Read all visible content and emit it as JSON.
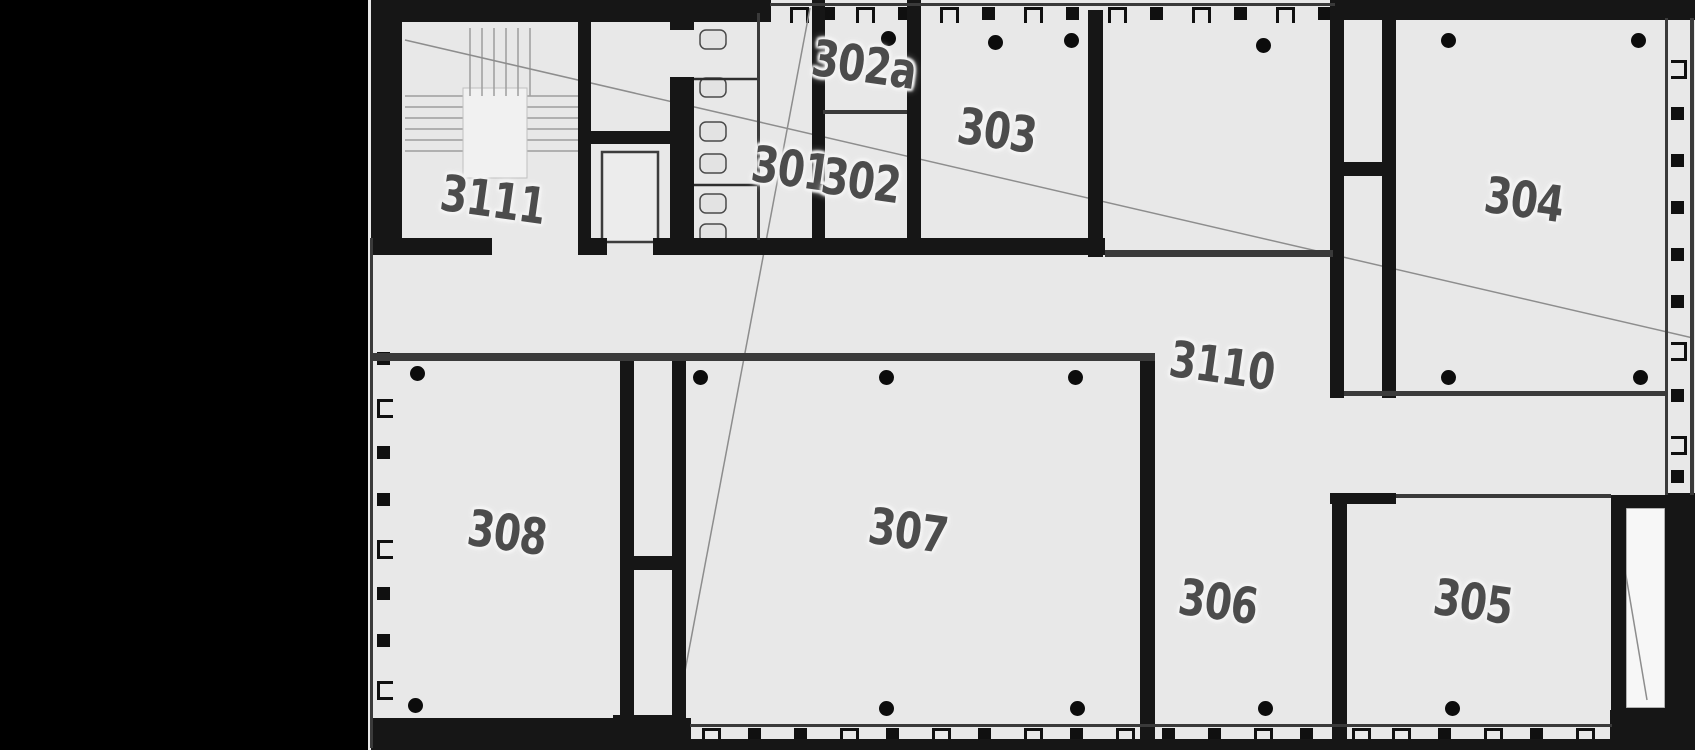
{
  "plan": {
    "colors": {
      "margin": "#000000",
      "floor": "#e8e8e8",
      "wall": "#161616",
      "thin_line": "#3a3a3a",
      "label_text": "#4c4c4c",
      "label_halo": "#f4f4f4",
      "leader_line": "#8d8d8d",
      "column_dot": "#0c0c0c"
    },
    "rooms": [
      {
        "label": "3111",
        "x": 493,
        "y": 200
      },
      {
        "label": "301",
        "x": 791,
        "y": 169
      },
      {
        "label": "302",
        "x": 861,
        "y": 181
      },
      {
        "label": "302a",
        "x": 864,
        "y": 65
      },
      {
        "label": "303",
        "x": 997,
        "y": 131
      },
      {
        "label": "304",
        "x": 1524,
        "y": 200
      },
      {
        "label": "3110",
        "x": 1222,
        "y": 366
      },
      {
        "label": "308",
        "x": 507,
        "y": 533
      },
      {
        "label": "307",
        "x": 908,
        "y": 531
      },
      {
        "label": "306",
        "x": 1218,
        "y": 602
      },
      {
        "label": "305",
        "x": 1473,
        "y": 602
      }
    ],
    "walls": [
      [
        371,
        0,
        400,
        22
      ],
      [
        1333,
        0,
        362,
        20
      ],
      [
        371,
        0,
        31,
        241
      ],
      [
        371,
        718,
        320,
        32
      ],
      [
        690,
        739,
        922,
        11
      ],
      [
        1610,
        710,
        85,
        40
      ],
      [
        1665,
        493,
        30,
        257
      ],
      [
        578,
        0,
        13,
        255
      ],
      [
        670,
        0,
        24,
        30
      ],
      [
        670,
        77,
        24,
        178
      ],
      [
        812,
        0,
        13,
        255
      ],
      [
        907,
        0,
        14,
        255
      ],
      [
        1088,
        10,
        15,
        247
      ],
      [
        1330,
        0,
        14,
        398
      ],
      [
        1382,
        0,
        14,
        398
      ],
      [
        1330,
        162,
        66,
        14
      ],
      [
        1140,
        357,
        15,
        382
      ],
      [
        620,
        357,
        14,
        360
      ],
      [
        672,
        357,
        14,
        382
      ],
      [
        620,
        556,
        66,
        14
      ],
      [
        613,
        715,
        73,
        35
      ],
      [
        1332,
        493,
        15,
        246
      ],
      [
        1330,
        493,
        66,
        11
      ],
      [
        1611,
        495,
        60,
        13
      ],
      [
        1611,
        708,
        60,
        35
      ],
      [
        1611,
        495,
        15,
        244
      ],
      [
        371,
        238,
        121,
        17
      ],
      [
        591,
        238,
        16,
        17
      ],
      [
        653,
        238,
        452,
        17
      ],
      [
        591,
        131,
        79,
        13
      ]
    ],
    "lines": [
      [
        770,
        3,
        565,
        3
      ],
      [
        370,
        238,
        3,
        510
      ],
      [
        690,
        724,
        922,
        3
      ],
      [
        1665,
        18,
        3,
        477
      ],
      [
        1690,
        18,
        4,
        477
      ],
      [
        757,
        13,
        3,
        227
      ],
      [
        823,
        110,
        84,
        4
      ],
      [
        1105,
        250,
        228,
        7
      ],
      [
        373,
        353,
        782,
        8
      ],
      [
        1344,
        391,
        321,
        5
      ],
      [
        1396,
        494,
        215,
        4
      ]
    ],
    "window_marks": {
      "size": 13,
      "items": [
        [
          790,
          7,
          "ob"
        ],
        [
          822,
          7,
          "f"
        ],
        [
          856,
          7,
          "ob"
        ],
        [
          898,
          7,
          "f"
        ],
        [
          940,
          7,
          "ob"
        ],
        [
          982,
          7,
          "f"
        ],
        [
          1024,
          7,
          "ob"
        ],
        [
          1066,
          7,
          "f"
        ],
        [
          1108,
          7,
          "ob"
        ],
        [
          1150,
          7,
          "f"
        ],
        [
          1192,
          7,
          "ob"
        ],
        [
          1234,
          7,
          "f"
        ],
        [
          1276,
          7,
          "ob"
        ],
        [
          1318,
          7,
          "f"
        ],
        [
          702,
          728,
          "ob"
        ],
        [
          748,
          728,
          "f"
        ],
        [
          794,
          728,
          "f"
        ],
        [
          840,
          728,
          "ob"
        ],
        [
          886,
          728,
          "f"
        ],
        [
          932,
          728,
          "ob"
        ],
        [
          978,
          728,
          "f"
        ],
        [
          1024,
          728,
          "ob"
        ],
        [
          1070,
          728,
          "f"
        ],
        [
          1116,
          728,
          "ob"
        ],
        [
          1162,
          728,
          "f"
        ],
        [
          1208,
          728,
          "f"
        ],
        [
          1254,
          728,
          "ob"
        ],
        [
          1300,
          728,
          "f"
        ],
        [
          1352,
          728,
          "ob"
        ],
        [
          1392,
          728,
          "ob"
        ],
        [
          1438,
          728,
          "f"
        ],
        [
          1484,
          728,
          "ob"
        ],
        [
          1530,
          728,
          "f"
        ],
        [
          1576,
          728,
          "ob"
        ],
        [
          377,
          352,
          "f"
        ],
        [
          377,
          399,
          "or"
        ],
        [
          377,
          446,
          "f"
        ],
        [
          377,
          493,
          "f"
        ],
        [
          377,
          540,
          "or"
        ],
        [
          377,
          587,
          "f"
        ],
        [
          377,
          634,
          "f"
        ],
        [
          377,
          681,
          "or"
        ],
        [
          1671,
          60,
          "ol"
        ],
        [
          1671,
          107,
          "f"
        ],
        [
          1671,
          154,
          "f"
        ],
        [
          1671,
          201,
          "f"
        ],
        [
          1671,
          248,
          "f"
        ],
        [
          1671,
          295,
          "f"
        ],
        [
          1671,
          342,
          "ol"
        ],
        [
          1671,
          389,
          "f"
        ],
        [
          1671,
          436,
          "ol"
        ],
        [
          1671,
          470,
          "f"
        ]
      ]
    },
    "columns": [
      [
        888,
        38
      ],
      [
        995,
        42
      ],
      [
        1071,
        40
      ],
      [
        1263,
        45
      ],
      [
        1448,
        40
      ],
      [
        1638,
        40
      ],
      [
        417,
        373
      ],
      [
        700,
        377
      ],
      [
        886,
        377
      ],
      [
        1075,
        377
      ],
      [
        1448,
        377
      ],
      [
        1640,
        377
      ],
      [
        415,
        705
      ],
      [
        886,
        708
      ],
      [
        1077,
        708
      ],
      [
        1265,
        708
      ],
      [
        1452,
        708
      ]
    ],
    "stairs": {
      "vlines_x": [
        470,
        482,
        494,
        506,
        518,
        530
      ],
      "vlines_y1": 28,
      "vlines_y2": 96,
      "hlines_y": [
        96,
        107,
        118,
        129,
        140,
        151
      ],
      "hlines_x1": 405,
      "hlines_x2": 585,
      "landing": [
        463,
        88,
        64,
        90
      ]
    },
    "fixtures": [
      [
        700,
        30
      ],
      [
        700,
        78
      ],
      [
        700,
        122
      ],
      [
        700,
        154
      ],
      [
        700,
        194
      ],
      [
        700,
        224
      ]
    ],
    "fixture_size": [
      26,
      19
    ],
    "stall_dividers": [
      [
        694,
        79,
        63
      ],
      [
        694,
        185,
        63
      ]
    ],
    "elevator": [
      602,
      152,
      56,
      90
    ],
    "shaft_box": [
      1626,
      508,
      39,
      200
    ],
    "leader_lines": [
      [
        405,
        40,
        1693,
        338
      ],
      [
        810,
        8,
        672,
        740
      ],
      [
        1620,
        540,
        1647,
        700
      ]
    ]
  }
}
